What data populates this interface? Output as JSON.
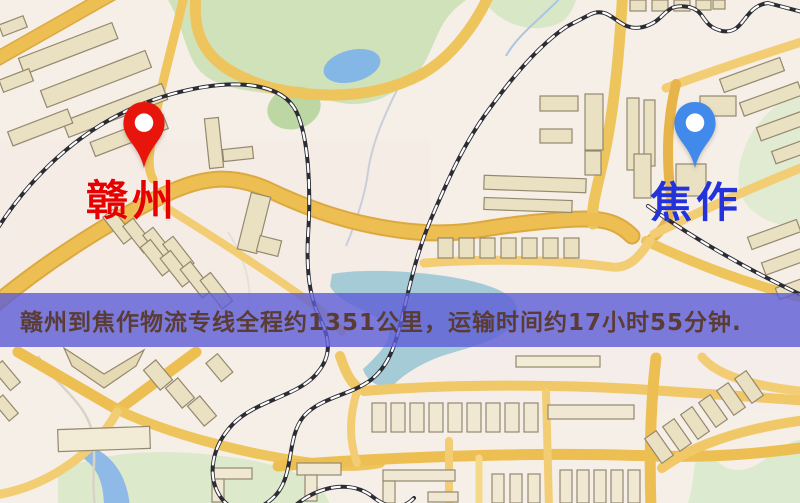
{
  "banner": {
    "text": "赣州到焦作物流专线全程约1351公里，运输时间约17小时55分钟.",
    "background_color": "#5c5dd7",
    "text_color": "#5a3c34"
  },
  "route_info": {
    "origin": "赣州",
    "destination": "焦作",
    "distance_km": "1351",
    "duration": "17小时55分钟"
  },
  "map": {
    "type": "street-map-illustration",
    "origin_marker": {
      "city": "赣州",
      "pin_color": "#e8150d",
      "label_color": "#e60000"
    },
    "destination_marker": {
      "city": "焦作",
      "pin_color": "#4189ea",
      "label_color": "#2433d9"
    },
    "palette": {
      "background": "#f6efe7",
      "road_major": "#edbe52",
      "road_minor": "#f2cd74",
      "building": "#eae0c2",
      "park_green": "#cfe2ba",
      "water_blue": "#8ab8e6",
      "river_teal": "#a5ccd6",
      "railway_dark": "#2c2c34"
    }
  }
}
